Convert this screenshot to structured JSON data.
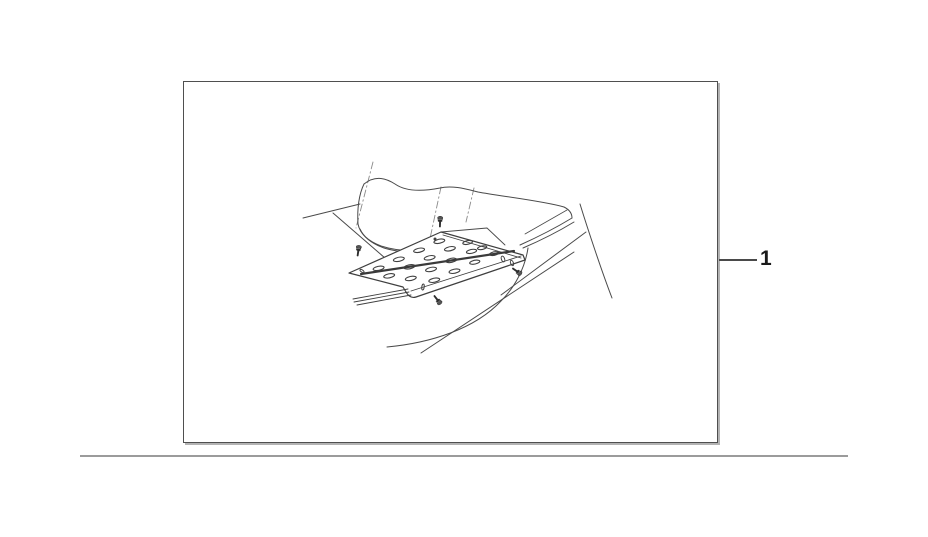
{
  "page": {
    "background_color": "#ffffff"
  },
  "diagram_box": {
    "border_color": "#4f4f4f",
    "shadow_color": "#b3b3b3",
    "background_color": "#ffffff"
  },
  "illustration": {
    "name": "floor-step-plate-with-mounting-screws",
    "stroke_color": "#444444",
    "heavy_ridge_color": "#3a3a3a",
    "phantom_line_color": "#8a8a8a",
    "screw_count": 4,
    "hole_style": "oval-perforations"
  },
  "callout": {
    "label": "1",
    "line_color": "#4a4a4a",
    "text_color": "#1a1a1a"
  },
  "footer_rule": {
    "color": "#9b9b9b"
  }
}
